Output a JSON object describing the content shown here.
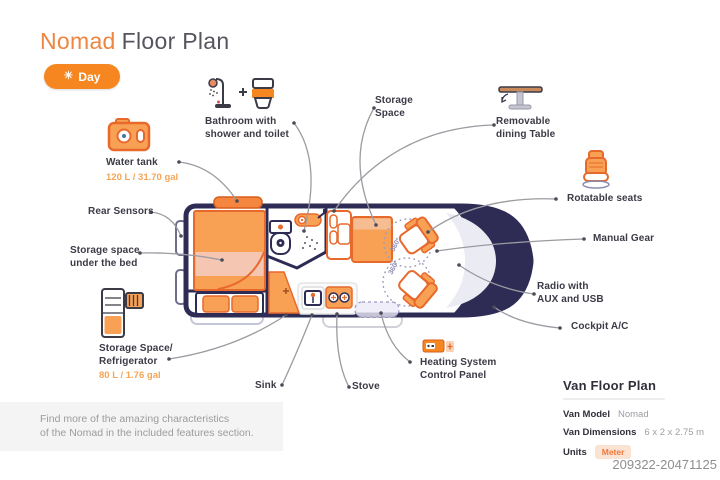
{
  "title": {
    "brand": "Nomad",
    "rest": "Floor Plan"
  },
  "mode_toggle": {
    "label": "Day",
    "icon": "sun-icon"
  },
  "features": {
    "water_tank": {
      "name": "Water tank",
      "capacity": "120 L / 31.70 gal"
    },
    "bathroom": {
      "line1": "Bathroom with",
      "line2": "shower and toilet"
    },
    "storage_space": {
      "line1": "Storage",
      "line2": "Space"
    },
    "dining_table": {
      "line1": "Removable",
      "line2": "dining Table"
    },
    "rotatable_seats": {
      "name": "Rotatable seats"
    },
    "manual_gear": {
      "name": "Manual Gear"
    },
    "radio": {
      "line1": "Radio with",
      "line2": "AUX and USB"
    },
    "cockpit_ac": {
      "name": "Cockpit A/C"
    },
    "rear_sensors": {
      "name": "Rear Sensors"
    },
    "under_bed": {
      "line1": "Storage space",
      "line2": "under the bed"
    },
    "fridge": {
      "line1": "Storage Space/",
      "line2": "Refrigerator",
      "capacity": "80 L / 1.76 gal"
    },
    "sink": {
      "name": "Sink"
    },
    "stove": {
      "name": "Stove"
    },
    "heating": {
      "line1": "Heating System",
      "line2": "Control Panel"
    }
  },
  "van": {
    "rotate_badge": "360°"
  },
  "note": {
    "line1": "Find more of the amazing characteristics",
    "line2": "of the Nomad in the included features section."
  },
  "spec_panel": {
    "title": "Van Floor Plan",
    "rows": [
      {
        "label": "Van Model",
        "value": "Nomad"
      },
      {
        "label": "Van Dimensions",
        "value": "6 x 2 x 2.75 m"
      },
      {
        "label": "Units",
        "value": "Meter"
      }
    ]
  },
  "watermark": "209322-20471125",
  "colors": {
    "accent_orange": "#F6861F",
    "furniture_fill": "#F8A155",
    "furniture_stroke": "#E8692C",
    "van_outline": "#2E2C55",
    "bed_pink": "#F5C7B2",
    "label_text": "#3B3B47",
    "capacity_text": "#F6A556",
    "leader_line": "#9B9BA1",
    "note_bg": "#F4F4F4"
  }
}
